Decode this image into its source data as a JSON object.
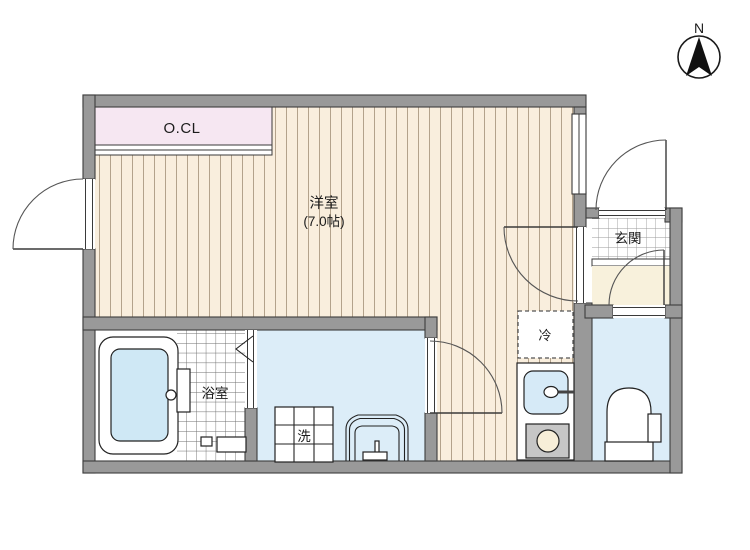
{
  "compass": {
    "label": "N"
  },
  "rooms": {
    "main": {
      "name": "洋室",
      "size": "(7.0帖)"
    },
    "closet": {
      "label": "O.CL"
    },
    "entrance": {
      "label": "玄関"
    },
    "bathroom": {
      "label": "浴室"
    }
  },
  "fixtures": {
    "washing_machine": "洗",
    "refrigerator": "冷"
  },
  "colors": {
    "wall": "#999999",
    "wall_outline": "#3d3d3d",
    "wood_floor": "#f9eedd",
    "wood_stripe": "#b3a28b",
    "closet": "#f6e7f2",
    "water_floor": "#dcedf8",
    "hall_floor": "#f8f1dc",
    "tub_water": "#cfe8f5",
    "sink": "#d6eaf7",
    "stove": "#c6c6c6",
    "burner": "#f7eed8",
    "tile_line": "#9a9a9a",
    "bath_tile_line": "#6e6e6e"
  }
}
